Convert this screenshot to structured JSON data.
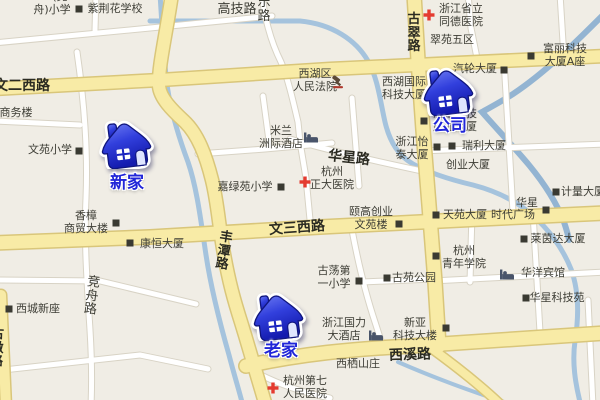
{
  "map": {
    "colors": {
      "background": "#f0ede5",
      "major_road_fill": "#f8eba6",
      "major_road_border": "#d9c67a",
      "minor_road_fill": "#ffffff",
      "minor_road_border": "#d8d3c5",
      "water": "#a5c3dd",
      "marker_blue": "#2b36d8",
      "marker_label_blue": "#2126d8",
      "poi_text": "#3d3d35"
    },
    "markers": [
      {
        "id": "new-home",
        "label": "新家",
        "icon": "house-icon",
        "x": 98,
        "y": 117,
        "label_x": 127,
        "label_y": 168
      },
      {
        "id": "company",
        "label": "公司",
        "icon": "house-icon",
        "x": 420,
        "y": 64,
        "label_x": 450,
        "label_y": 111
      },
      {
        "id": "old-home",
        "label": "老家",
        "icon": "house-icon",
        "x": 250,
        "y": 289,
        "label_x": 281,
        "label_y": 336
      }
    ],
    "road_labels": [
      {
        "text": "文二西路",
        "x": 22,
        "y": 79,
        "rot": 0
      },
      {
        "text": "文三西路",
        "x": 297,
        "y": 221,
        "rot": -4
      },
      {
        "text": "西溪路",
        "x": 410,
        "y": 348,
        "rot": -2
      },
      {
        "text": "华星路",
        "x": 349,
        "y": 151,
        "rot": 6,
        "bold": true
      },
      {
        "text": "高技路",
        "x": 237,
        "y": 3,
        "rot": 0,
        "minor": true
      },
      {
        "text": "乐路",
        "x": 264,
        "y": -4,
        "rot": 0,
        "vertical": true,
        "minor": true
      },
      {
        "text": "丰潭路",
        "x": 224,
        "y": 231,
        "rot": 9,
        "vertical": true
      },
      {
        "text": "古翠路",
        "x": 414,
        "y": 13,
        "rot": 0,
        "vertical": true
      },
      {
        "text": "竞舟路",
        "x": 92,
        "y": 276,
        "rot": 7,
        "vertical": true,
        "minor": true
      },
      {
        "text": "古墩路",
        "x": -3,
        "y": 328,
        "rot": 2,
        "vertical": true
      }
    ],
    "pois": [
      {
        "lines": [
          "(竞"
        ],
        "x": 60,
        "y": -9
      },
      {
        "lines": [
          "舟)小学"
        ],
        "x": 52,
        "y": 4
      },
      {
        "lines": [
          "紫荆花学校"
        ],
        "x": 115,
        "y": 3,
        "icon": "square-marker-icon",
        "icon_x": 79,
        "icon_y": 9
      },
      {
        "lines": [
          "商务楼"
        ],
        "x": 16,
        "y": 107
      },
      {
        "lines": [
          "文苑小学"
        ],
        "x": 50,
        "y": 144,
        "icon": "square-marker-icon",
        "icon_x": 79,
        "icon_y": 151
      },
      {
        "lines": [
          "香樟",
          "商贸大楼"
        ],
        "x": 86,
        "y": 210,
        "icon": "square-marker-icon",
        "icon_x": 116,
        "icon_y": 223
      },
      {
        "lines": [
          "康恒大厦"
        ],
        "x": 162,
        "y": 238,
        "icon": "square-marker-icon",
        "icon_x": 130,
        "icon_y": 243
      },
      {
        "lines": [
          "西城新座"
        ],
        "x": 38,
        "y": 303,
        "icon": "square-marker-icon",
        "icon_x": 9,
        "icon_y": 309
      },
      {
        "lines": [
          "西湖区",
          "人民法院"
        ],
        "x": 315,
        "y": 68,
        "icon": "gavel-icon",
        "icon_x": 338,
        "icon_y": 82
      },
      {
        "lines": [
          "米兰",
          "洲际酒店"
        ],
        "x": 281,
        "y": 125,
        "icon": "bed-icon",
        "icon_x": 311,
        "icon_y": 137
      },
      {
        "lines": [
          "嘉绿苑小学"
        ],
        "x": 245,
        "y": 181,
        "icon": "square-marker-icon",
        "icon_x": 281,
        "icon_y": 187
      },
      {
        "lines": [
          "杭州",
          "正大医院"
        ],
        "x": 332,
        "y": 166,
        "icon": "red-cross-icon",
        "icon_x": 305,
        "icon_y": 182
      },
      {
        "lines": [
          "颐高创业",
          "文苑楼"
        ],
        "x": 371,
        "y": 206,
        "icon": "square-marker-icon",
        "icon_x": 399,
        "icon_y": 224
      },
      {
        "lines": [
          "古荡第",
          "一小学"
        ],
        "x": 334,
        "y": 265,
        "icon": "square-marker-icon",
        "icon_x": 359,
        "icon_y": 281
      },
      {
        "lines": [
          "古苑公园"
        ],
        "x": 414,
        "y": 272,
        "icon": "square-marker-icon",
        "icon_x": 387,
        "icon_y": 278
      },
      {
        "lines": [
          "浙江国力",
          "大酒店"
        ],
        "x": 344,
        "y": 317,
        "icon": "bed-icon",
        "icon_x": 376,
        "icon_y": 335
      },
      {
        "lines": [
          "西栖山庄"
        ],
        "x": 358,
        "y": 358
      },
      {
        "lines": [
          "杭州第七",
          "人民医院"
        ],
        "x": 305,
        "y": 375,
        "icon": "red-cross-icon",
        "icon_x": 273,
        "icon_y": 388
      },
      {
        "lines": [
          "浙江省立",
          "同德医院"
        ],
        "x": 461,
        "y": 3,
        "icon": "red-cross-icon",
        "icon_x": 429,
        "icon_y": 15
      },
      {
        "lines": [
          "翠苑五区"
        ],
        "x": 452,
        "y": 34
      },
      {
        "lines": [
          "富丽科技",
          "大厦A座"
        ],
        "x": 565,
        "y": 43,
        "icon": "square-marker-icon",
        "icon_x": 531,
        "icon_y": 56
      },
      {
        "lines": [
          "汽轮大厦"
        ],
        "x": 475,
        "y": 63,
        "icon": "square-marker-icon",
        "icon_x": 504,
        "icon_y": 70
      },
      {
        "lines": [
          "西湖国际",
          "科技大厦"
        ],
        "x": 404,
        "y": 76
      },
      {
        "lines": [
          "浙江科技",
          "产业大厦"
        ],
        "x": 455,
        "y": 108,
        "icon": "square-marker-icon",
        "icon_x": 424,
        "icon_y": 121
      },
      {
        "lines": [
          "浙江怡",
          "泰大厦"
        ],
        "x": 412,
        "y": 136,
        "icon": "square-marker-icon",
        "icon_x": 437,
        "icon_y": 147
      },
      {
        "lines": [
          "瑞利大厦"
        ],
        "x": 484,
        "y": 140,
        "icon": "square-marker-icon",
        "icon_x": 452,
        "icon_y": 146
      },
      {
        "lines": [
          "创业大厦"
        ],
        "x": 468,
        "y": 159
      },
      {
        "lines": [
          "计量大厦"
        ],
        "x": 583,
        "y": 186,
        "icon": "square-marker-icon",
        "icon_x": 556,
        "icon_y": 192
      },
      {
        "lines": [
          "天苑大厦"
        ],
        "x": 465,
        "y": 209,
        "icon": "square-marker-icon",
        "icon_x": 436,
        "icon_y": 215
      },
      {
        "lines": [
          "时代广场"
        ],
        "x": 513,
        "y": 209
      },
      {
        "lines": [
          "华星"
        ],
        "x": 527,
        "y": 197,
        "icon": "square-marker-icon",
        "icon_x": 546,
        "icon_y": 210
      },
      {
        "lines": [
          "莱茵达大厦"
        ],
        "x": 558,
        "y": 233,
        "icon": "square-marker-icon",
        "icon_x": 524,
        "icon_y": 239
      },
      {
        "lines": [
          "杭州",
          "青年学院"
        ],
        "x": 464,
        "y": 245,
        "icon": "square-marker-icon",
        "icon_x": 436,
        "icon_y": 256
      },
      {
        "lines": [
          "华洋宾馆"
        ],
        "x": 543,
        "y": 267,
        "icon": "bed-icon",
        "icon_x": 507,
        "icon_y": 274
      },
      {
        "lines": [
          "华星科技苑"
        ],
        "x": 557,
        "y": 292,
        "icon": "square-marker-icon",
        "icon_x": 526,
        "icon_y": 298
      },
      {
        "lines": [
          "新亚",
          "科技大楼"
        ],
        "x": 415,
        "y": 317,
        "icon": "square-marker-icon",
        "icon_x": 446,
        "icon_y": 328
      }
    ]
  }
}
